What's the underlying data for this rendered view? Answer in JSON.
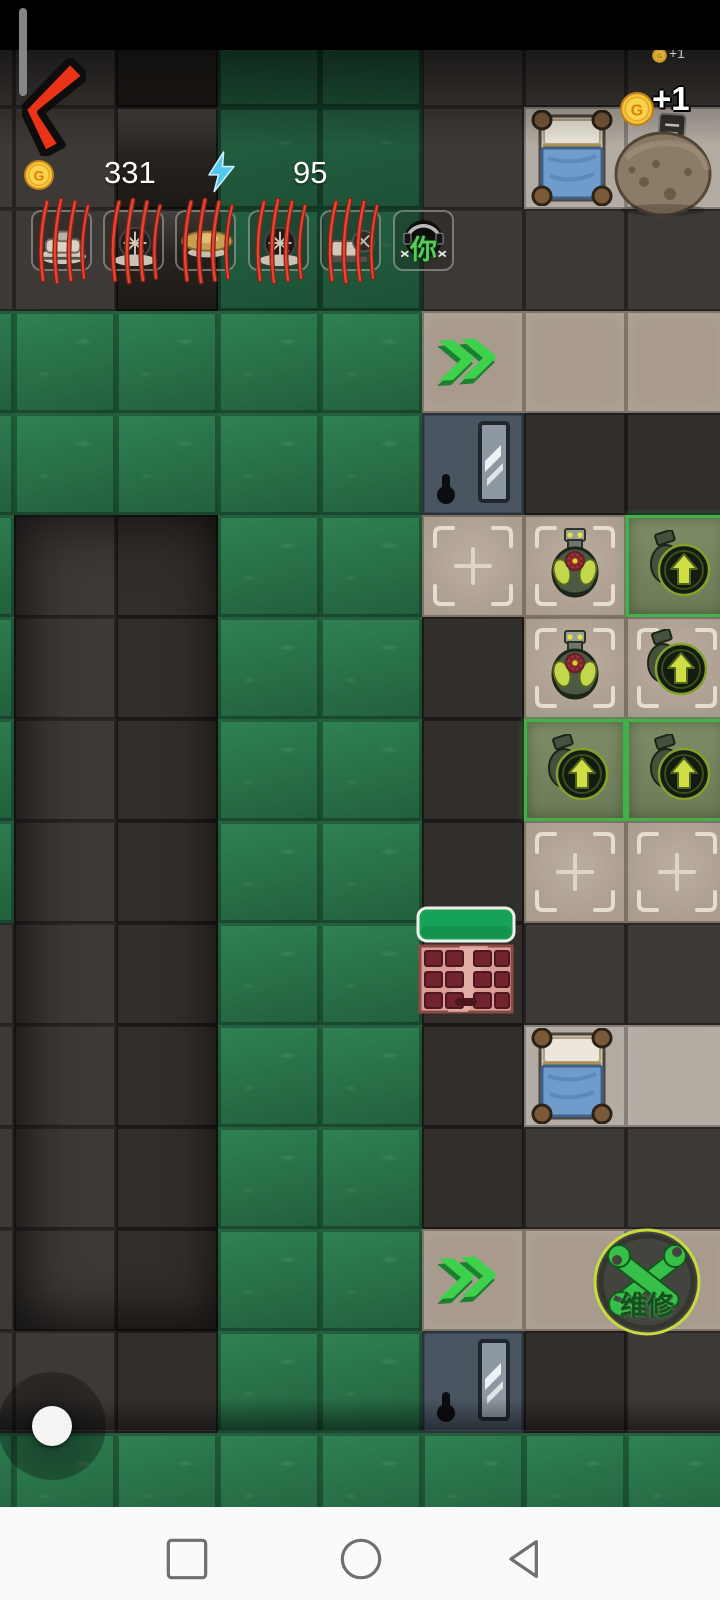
{
  "app": {
    "title": "base-defense-game-screen"
  },
  "hud": {
    "coin_letter": "G",
    "coins": "331",
    "energy": "95",
    "floating_reward": "+1",
    "floating_reward_small": "+1",
    "you_label": "你",
    "repair_label": "维修",
    "slots": [
      {
        "name": "unit-slot-1",
        "variant": "wreck-a",
        "destroyed": true
      },
      {
        "name": "unit-slot-2",
        "variant": "wreck-b",
        "destroyed": true
      },
      {
        "name": "unit-slot-3",
        "variant": "disc",
        "destroyed": true
      },
      {
        "name": "unit-slot-4",
        "variant": "wreck-b",
        "destroyed": true
      },
      {
        "name": "unit-slot-5",
        "variant": "wreck-c",
        "destroyed": true
      },
      {
        "name": "unit-slot-you",
        "variant": "you",
        "destroyed": false
      }
    ]
  },
  "map": {
    "tile_size": 102,
    "origin_x": -88,
    "origin_y": 5,
    "legend": {
      "G": "grass-tile",
      "g": "grass-tile-dark",
      "D": "floor-tile",
      "d": "floor-tile-dark",
      "B": "floor-tile-black",
      "T": "path-tile",
      "L": "room-tile",
      "R": "door-tile",
      "S+": "build-slot-empty",
      "St": "slot-bomb-turret",
      "Su": "slot-bomb-upgrade",
      "Vu": "slot-bomb-upgrade-active"
    },
    "grid": [
      [
        "D",
        "D",
        "B",
        "g",
        "g",
        "D",
        "D",
        "D"
      ],
      [
        "D",
        "D",
        "B",
        "g",
        "g",
        "D",
        "L",
        "L"
      ],
      [
        "D",
        "D",
        "B",
        "g",
        "g",
        "D",
        "D",
        "D"
      ],
      [
        "G",
        "G",
        "G",
        "G",
        "G",
        "T",
        "T",
        "T"
      ],
      [
        "G",
        "G",
        "G",
        "G",
        "G",
        "R",
        "d",
        "d"
      ],
      [
        "G",
        "D",
        "d",
        "G",
        "G",
        "S+",
        "St",
        "Vu"
      ],
      [
        "G",
        "D",
        "d",
        "G",
        "G",
        "d",
        "St",
        "Su"
      ],
      [
        "G",
        "D",
        "d",
        "G",
        "G",
        "d",
        "Vu",
        "Vu"
      ],
      [
        "G",
        "D",
        "d",
        "G",
        "G",
        "d",
        "S+",
        "S+"
      ],
      [
        "D",
        "D",
        "d",
        "G",
        "G",
        "d",
        "D",
        "D"
      ],
      [
        "D",
        "D",
        "d",
        "G",
        "G",
        "d",
        "L",
        "L"
      ],
      [
        "D",
        "D",
        "d",
        "G",
        "G",
        "d",
        "D",
        "D"
      ],
      [
        "D",
        "D",
        "d",
        "G",
        "G",
        "T",
        "T",
        "T"
      ],
      [
        "D",
        "D",
        "d",
        "G",
        "G",
        "R",
        "d",
        "D"
      ],
      [
        "G",
        "G",
        "G",
        "G",
        "G",
        "G",
        "G",
        "G"
      ]
    ],
    "overlays": [
      {
        "type": "bed",
        "x": 530,
        "y": 110
      },
      {
        "type": "boulder",
        "x": 608,
        "y": 112
      },
      {
        "type": "chevrons",
        "x": 438,
        "y": 330
      },
      {
        "type": "wall",
        "x": 416,
        "y": 906
      },
      {
        "type": "bed",
        "x": 530,
        "y": 1028
      },
      {
        "type": "chevrons",
        "x": 438,
        "y": 1248
      },
      {
        "type": "repair",
        "x": 591,
        "y": 1226
      }
    ]
  },
  "colors": {
    "grass": "#2c7a4d",
    "path_tan": "#a89b8e",
    "slot_border_green": "#41b14a",
    "claw_red": "#c13024",
    "repair_green": "#36bf49",
    "health_green": "#16a257",
    "coin_gold": "#f6c636",
    "arrow_green": "#3ed14b",
    "back_arrow_red": "#ea3317"
  },
  "navbar": {
    "icons": [
      "recents-square",
      "home-circle",
      "back-triangle"
    ]
  }
}
